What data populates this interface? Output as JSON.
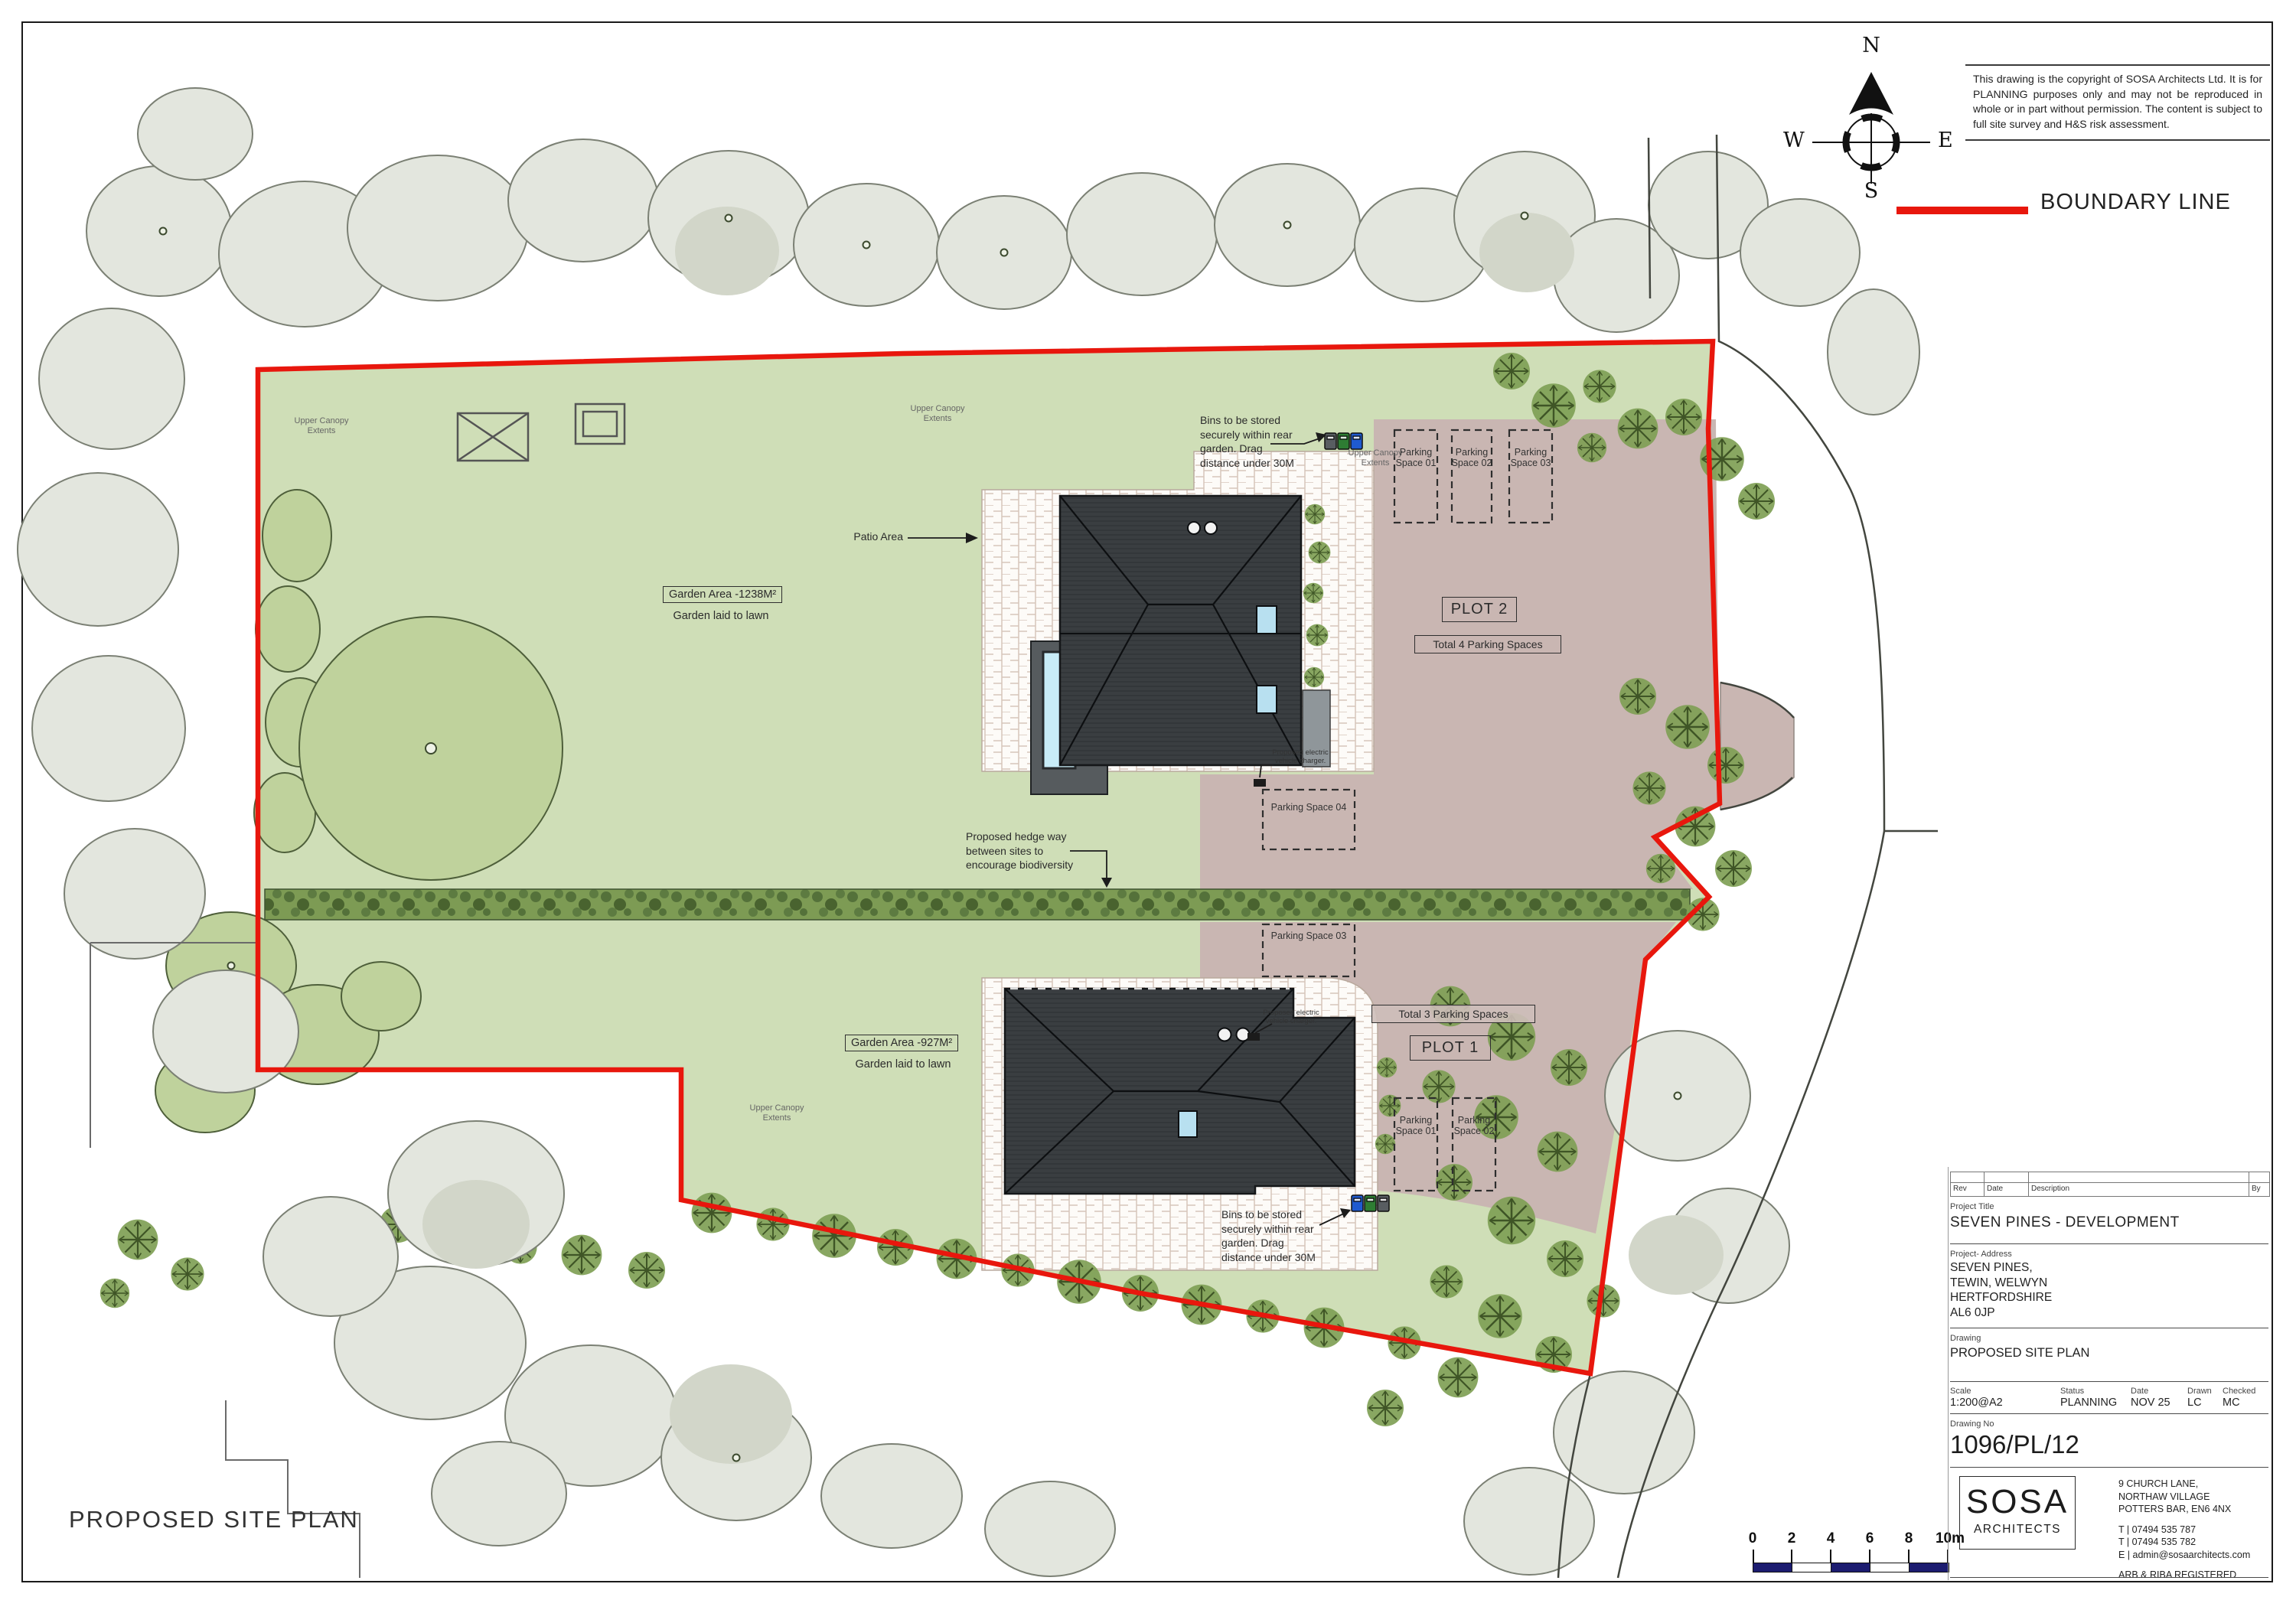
{
  "page": {
    "plan_title": "PROPOSED SITE PLAN"
  },
  "copyright": {
    "text": "This drawing is the copyright of SOSA Architects Ltd.  It is for PLANNING purposes only and may not be reproduced in whole or in part without permission.   The content is subject to full site survey and H&S risk assessment."
  },
  "legend": {
    "boundary": "BOUNDARY LINE"
  },
  "compass": {
    "n": "N",
    "e": "E",
    "s": "S",
    "w": "W"
  },
  "site": {
    "patio_label": "Patio Area",
    "garden_plot2": {
      "area": "Garden Area -1238M²",
      "sub": "Garden laid to lawn"
    },
    "garden_plot1": {
      "area": "Garden Area -927M²",
      "sub": "Garden laid to lawn"
    },
    "hedge_note": "Proposed hedge way between sites to encourage biodiversity",
    "bins_note_plot2": "Bins to be stored securely within rear garden. Drag distance under 30M",
    "bins_note_plot1": "Bins to be stored securely within rear garden. Drag distance under 30M",
    "ev_note": "Proposed electric vehicle charger.",
    "canopy_note": "Upper Canopy Extents",
    "plot2": {
      "label": "PLOT 2",
      "total": "Total 4 Parking Spaces",
      "spaces": [
        "Parking Space 01",
        "Parking Space 02",
        "Parking Space 03",
        "Parking Space 04"
      ]
    },
    "plot1": {
      "label": "PLOT 1",
      "total": "Total 3 Parking Spaces",
      "spaces": [
        "Parking Space 01",
        "Parking Space 02",
        "Parking Space 03"
      ]
    }
  },
  "scalebar": {
    "ticks": [
      "0",
      "2",
      "4",
      "6",
      "8",
      "10m"
    ]
  },
  "titleblock": {
    "rev_headers": [
      "Rev",
      "Date",
      "Description",
      "By"
    ],
    "project_title_label": "Project Title",
    "project_title": "SEVEN PINES - DEVELOPMENT",
    "address_label": "Project- Address",
    "address_lines": [
      "SEVEN PINES,",
      "TEWIN, WELWYN",
      "HERTFORDSHIRE",
      "AL6 0JP"
    ],
    "drawing_label": "Drawing",
    "drawing": "PROPOSED SITE PLAN",
    "scale_label": "Scale",
    "scale": "1:200@A2",
    "status_label": "Status",
    "status": "PLANNING",
    "date_label": "Date",
    "date": "NOV 25",
    "drawn_label": "Drawn",
    "drawn": "LC",
    "checked_label": "Checked",
    "checked": "MC",
    "drawing_no_label": "Drawing No",
    "drawing_no": "1096/PL/12",
    "firm": {
      "name": "SOSA",
      "type": "ARCHITECTS",
      "address": [
        "9 CHURCH LANE,",
        "NORTHAW VILLAGE",
        "POTTERS BAR, EN6 4NX"
      ],
      "phone1": "T | 07494 535 787",
      "phone2": "T | 07494 535 782",
      "email": "E | admin@sosaarchitects.com",
      "registered": "ARB & RIBA REGISTERED"
    }
  }
}
